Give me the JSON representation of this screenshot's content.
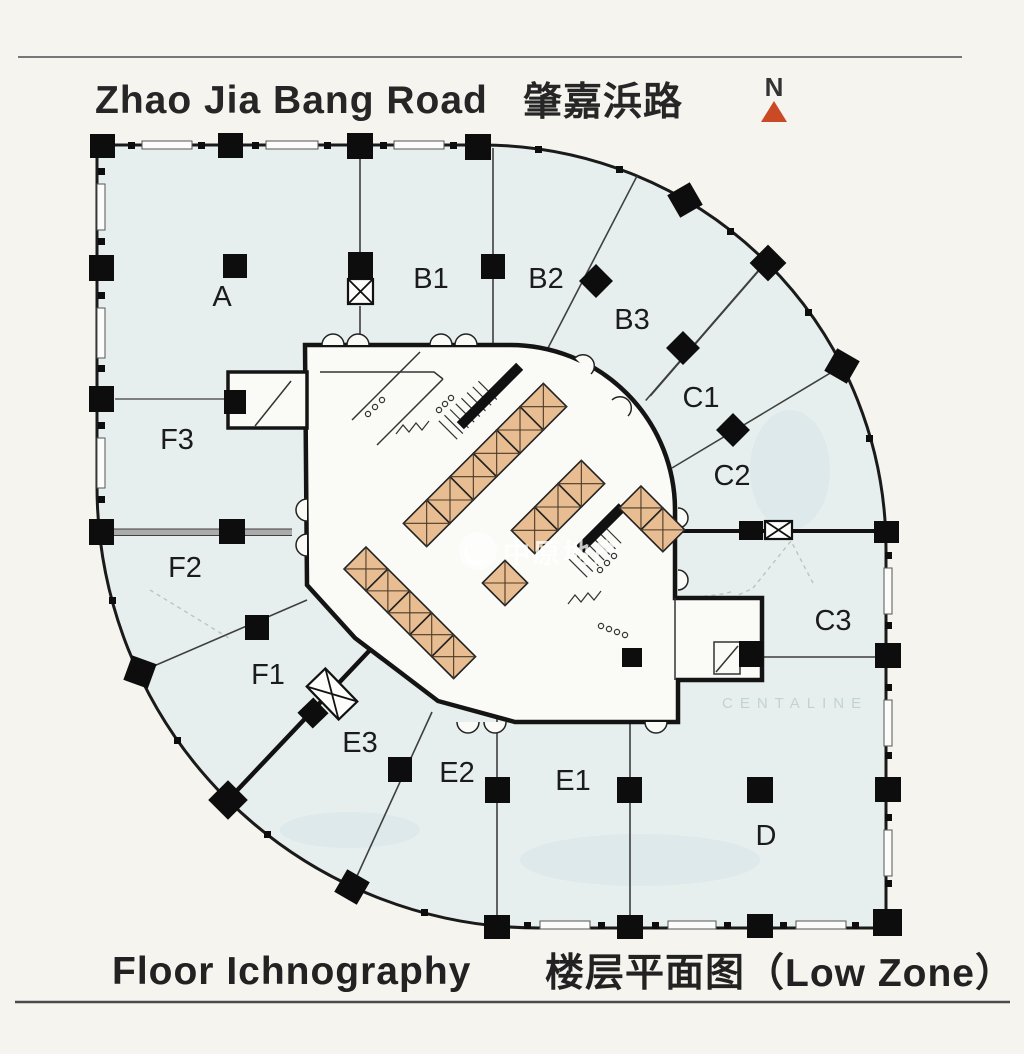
{
  "header": {
    "road_en": "Zhao Jia Bang Road",
    "road_zh": "肇嘉浜路",
    "north_label": "N"
  },
  "footer": {
    "caption_en": "Floor Ichnography",
    "caption_zh": "楼层平面图（Low Zone）"
  },
  "plan": {
    "zones": [
      {
        "label": "A"
      },
      {
        "label": "B1"
      },
      {
        "label": "B2"
      },
      {
        "label": "B3"
      },
      {
        "label": "C1"
      },
      {
        "label": "C2"
      },
      {
        "label": "C3"
      },
      {
        "label": "D"
      },
      {
        "label": "E1"
      },
      {
        "label": "E2"
      },
      {
        "label": "E3"
      },
      {
        "label": "F1"
      },
      {
        "label": "F2"
      },
      {
        "label": "F3"
      }
    ],
    "watermark": {
      "text": "中原地产"
    },
    "faint_text": "CENTALINE"
  },
  "colors": {
    "north_arrow": "#cb4a26",
    "plan_fill": "#e7efee",
    "elevator_fill": "#e9bd92",
    "wall": "#1a1a1a",
    "core_fill": "#fafbf7"
  }
}
